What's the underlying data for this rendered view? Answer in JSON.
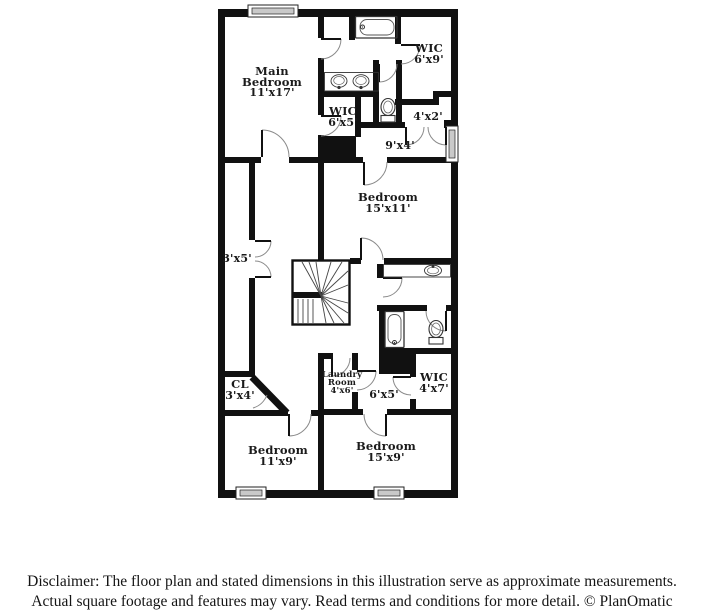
{
  "plan": {
    "title": "Second floor plan",
    "rooms": [
      {
        "id": "main-bedroom",
        "name_line1": "Main",
        "name_line2": "Bedroom",
        "dims": "11'x17'"
      },
      {
        "id": "wic-top-right",
        "name": "WIC",
        "dims": "6'x9'"
      },
      {
        "id": "wic-middle",
        "name": "WIC",
        "dims": "6'x5'"
      },
      {
        "id": "closet-4x2",
        "dims": "4'x2'"
      },
      {
        "id": "hall-9x4",
        "dims": "9'x4'"
      },
      {
        "id": "bedroom-15x11",
        "name": "Bedroom",
        "dims": "15'x11'"
      },
      {
        "id": "closet-3x5",
        "dims": "3'x5'"
      },
      {
        "id": "closet-cl",
        "name": "CL",
        "dims": "3'x4'"
      },
      {
        "id": "laundry-room",
        "name_line1": "Laundry",
        "name_line2": "Room",
        "dims": "4'x6'"
      },
      {
        "id": "hall-6x5",
        "dims": "6'x5'"
      },
      {
        "id": "wic-bottom-right",
        "name": "WIC",
        "dims": "4'x7'"
      },
      {
        "id": "bedroom-11x9",
        "name": "Bedroom",
        "dims": "11'x9'"
      },
      {
        "id": "bedroom-15x9",
        "name": "Bedroom",
        "dims": "15'x9'"
      }
    ],
    "fixtures": [
      "bathtub",
      "double-sink-vanity",
      "toilet",
      "sink-vanity",
      "bathtub",
      "toilet",
      "winder-staircase"
    ],
    "window_count": 4,
    "door_count": 17
  },
  "disclaimer": {
    "line1": "Disclaimer: The floor plan and stated dimensions in this illustration serve as approximate measurements.",
    "line2": "Actual square footage and features may vary. Read terms and conditions for more detail. © PlanOmatic"
  },
  "colors": {
    "wall": "#111111",
    "background": "#ffffff",
    "label": "#1b1b1b",
    "door_arc": "#8a8a8a",
    "fixture_stroke": "#333333",
    "window_fill": "#c9c9c9"
  }
}
